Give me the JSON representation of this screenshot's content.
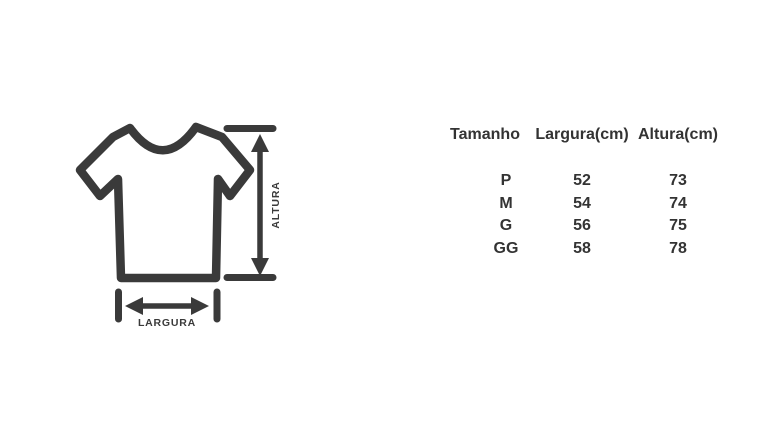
{
  "page": {
    "background_color": "#ffffff",
    "text_color": "#333333"
  },
  "diagram": {
    "icon": "t-shirt-outline-icon",
    "stroke_color": "#3a3a3a",
    "height_label": "ALTURA",
    "width_label": "LARGURA"
  },
  "size_table": {
    "columns": [
      "Tamanho",
      "Largura(cm)",
      "Altura(cm)"
    ],
    "rows": [
      [
        "P",
        "52",
        "73"
      ],
      [
        "M",
        "54",
        "74"
      ],
      [
        "G",
        "56",
        "75"
      ],
      [
        "GG",
        "58",
        "78"
      ]
    ]
  }
}
